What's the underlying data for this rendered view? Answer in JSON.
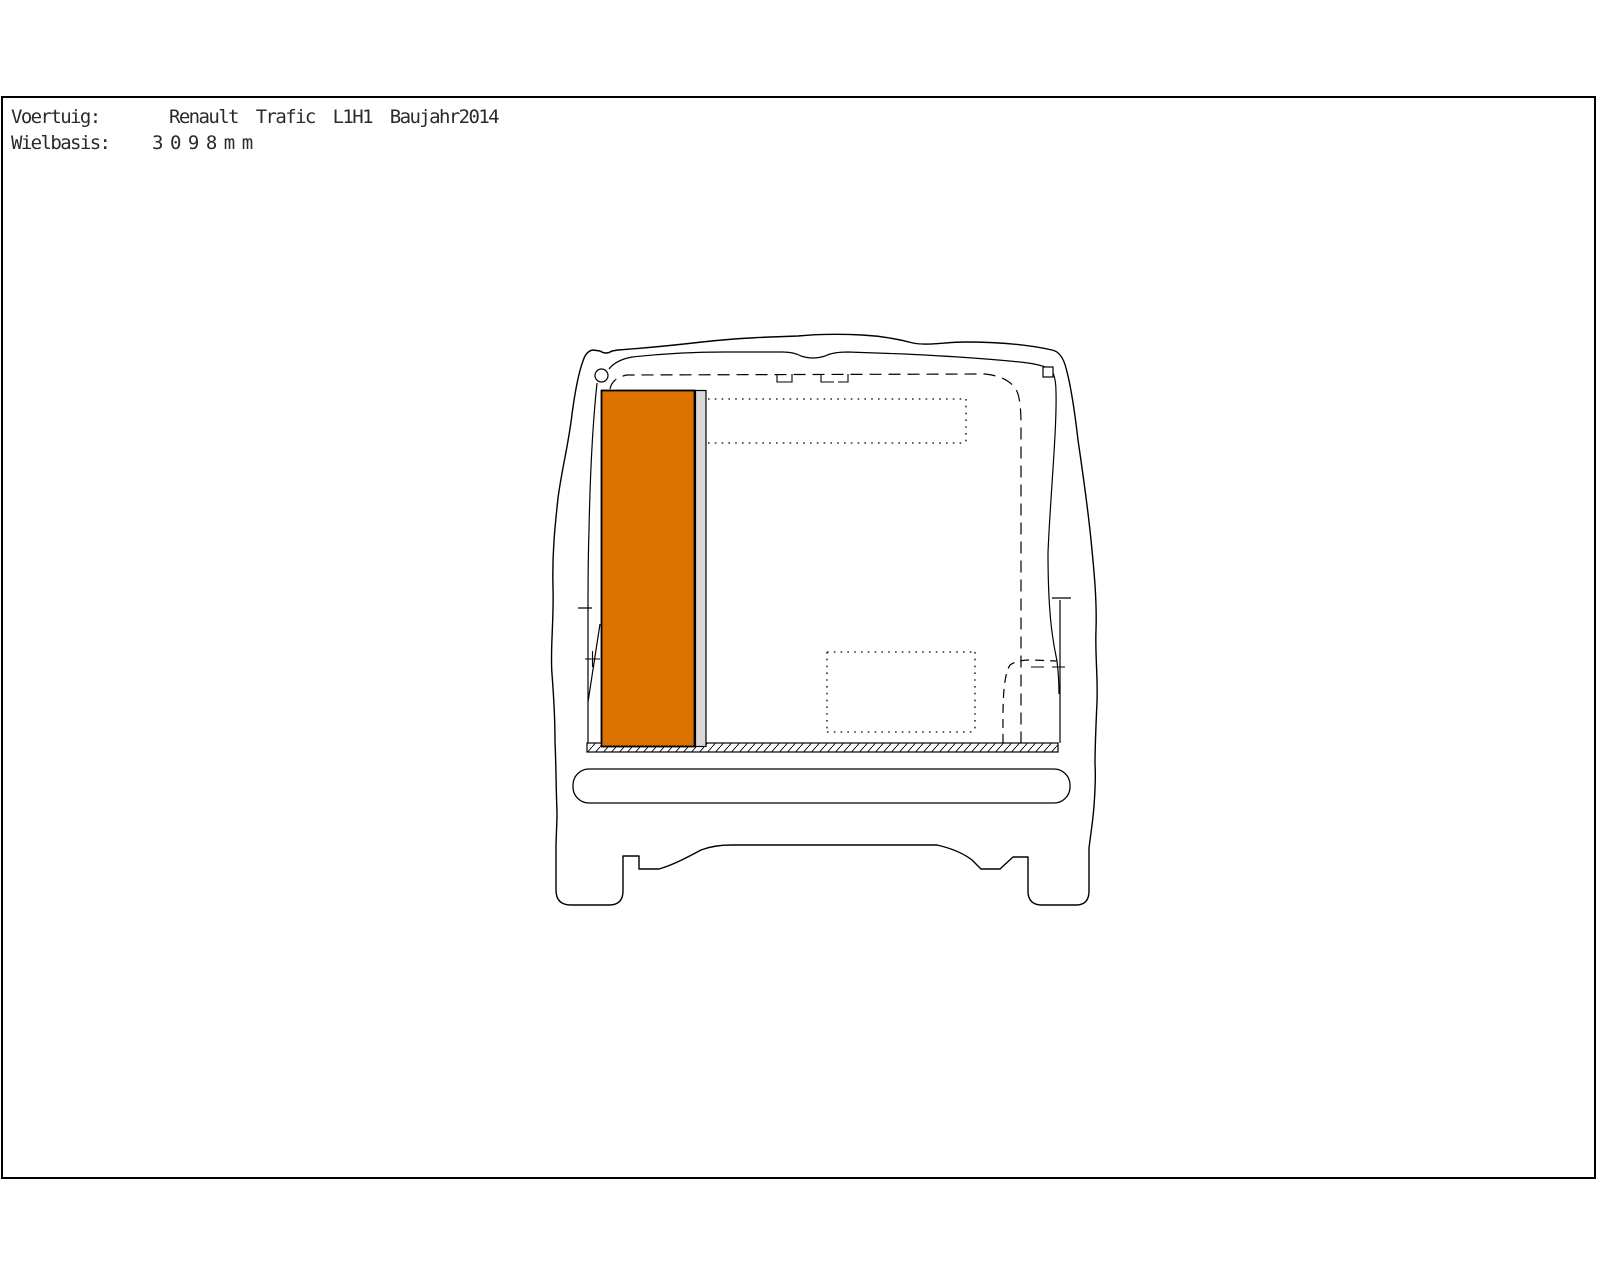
{
  "header": {
    "vehicle_label": "Voertuig:",
    "vehicle_value": "Renault Trafic L1H1 Baujahr2014",
    "wheelbase_label": "Wielbasis:",
    "wheelbase_value": "3098mm"
  },
  "drawing": {
    "colors": {
      "background": "#FFFFFF",
      "frame": "#000000",
      "outline": "#000000",
      "module_fill": "#DC7300",
      "module_side_fill": "#D9D9D9",
      "marker_fill": "#FFFFFF"
    }
  }
}
